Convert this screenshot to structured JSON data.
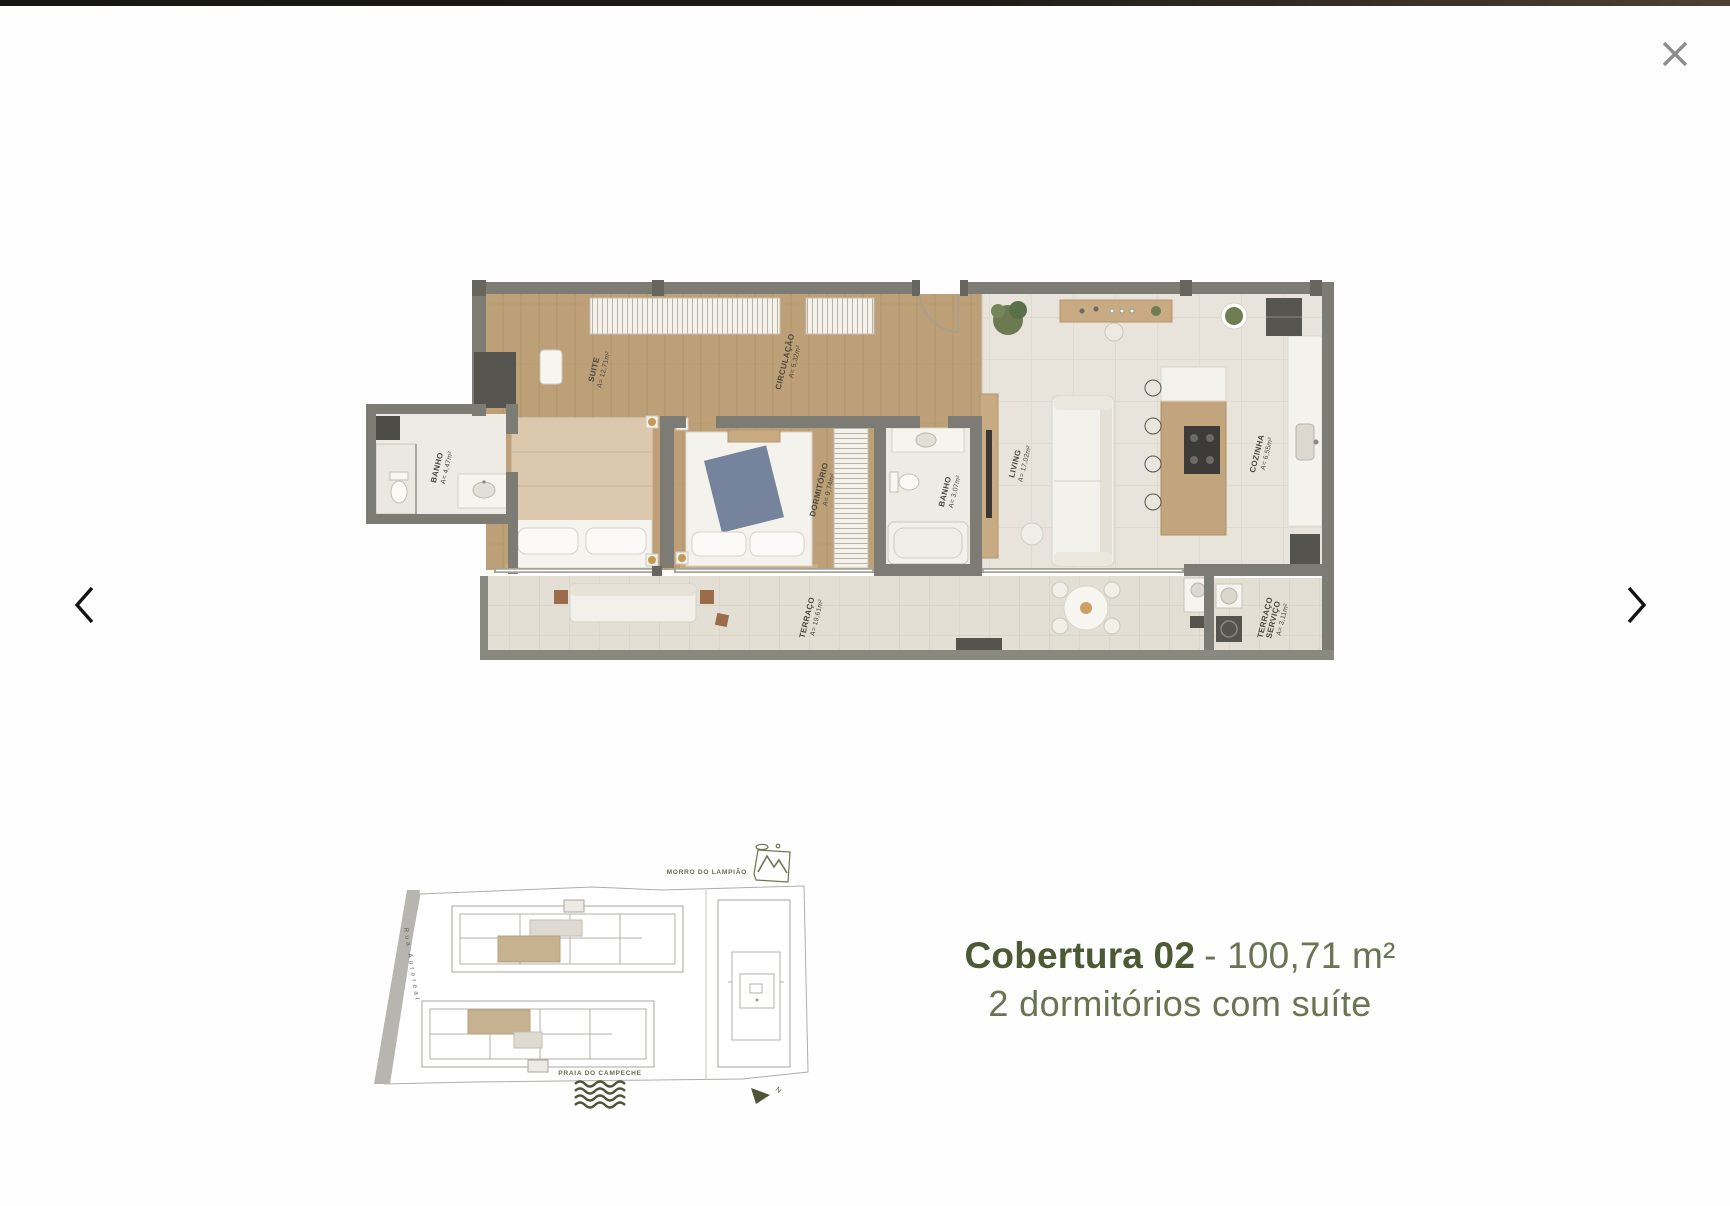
{
  "overlay": {
    "icons": {
      "close": "close-icon",
      "prev": "chevron-left-icon",
      "next": "chevron-right-icon"
    }
  },
  "caption": {
    "title_bold": "Cobertura 02",
    "title_regular": "- 100,71 m²",
    "subtitle": "2 dormitórios com suíte"
  },
  "floor_plan": {
    "rooms": [
      {
        "id": "suite",
        "lines": [
          "SUITE",
          "A= 12,71m²"
        ]
      },
      {
        "id": "circulacao",
        "lines": [
          "CIRCULAÇÃO",
          "A= 5,32m²"
        ]
      },
      {
        "id": "dormitorio",
        "lines": [
          "DORMITÓRIO",
          "A= 9,74m²"
        ]
      },
      {
        "id": "banho-suite",
        "lines": [
          "BANHO",
          "A= 4,47m²"
        ]
      },
      {
        "id": "banho",
        "lines": [
          "BANHO",
          "A= 3,07m²"
        ]
      },
      {
        "id": "living",
        "lines": [
          "LIVING",
          "A= 17,02m²"
        ]
      },
      {
        "id": "cozinha",
        "lines": [
          "COZINHA",
          "A= 6,55m²"
        ]
      },
      {
        "id": "terraco",
        "lines": [
          "TERRAÇO",
          "A= 19,61m²"
        ]
      },
      {
        "id": "terraco-servico",
        "lines": [
          "TERRAÇO",
          "SERVIÇO",
          "A= 3,11m²"
        ]
      }
    ]
  },
  "site_map": {
    "hill_label": "MORRO DO LAMPIÃO",
    "street_label": "Rua Auroreal",
    "beach_label": "PRAIA DO CAMPECHE",
    "compass_letter": "N",
    "icons": {
      "hill": "mountain-icon",
      "beach": "waves-icon",
      "north": "compass-icon"
    }
  },
  "colors": {
    "accent_dark": "#4d5834",
    "accent": "#6b7352",
    "map_accent": "#4f5436",
    "walls": "#7c7b74",
    "wood_floor": "#bda077",
    "highlight_unit": "#c7b28f",
    "close_gray": "#8d8d8d"
  }
}
